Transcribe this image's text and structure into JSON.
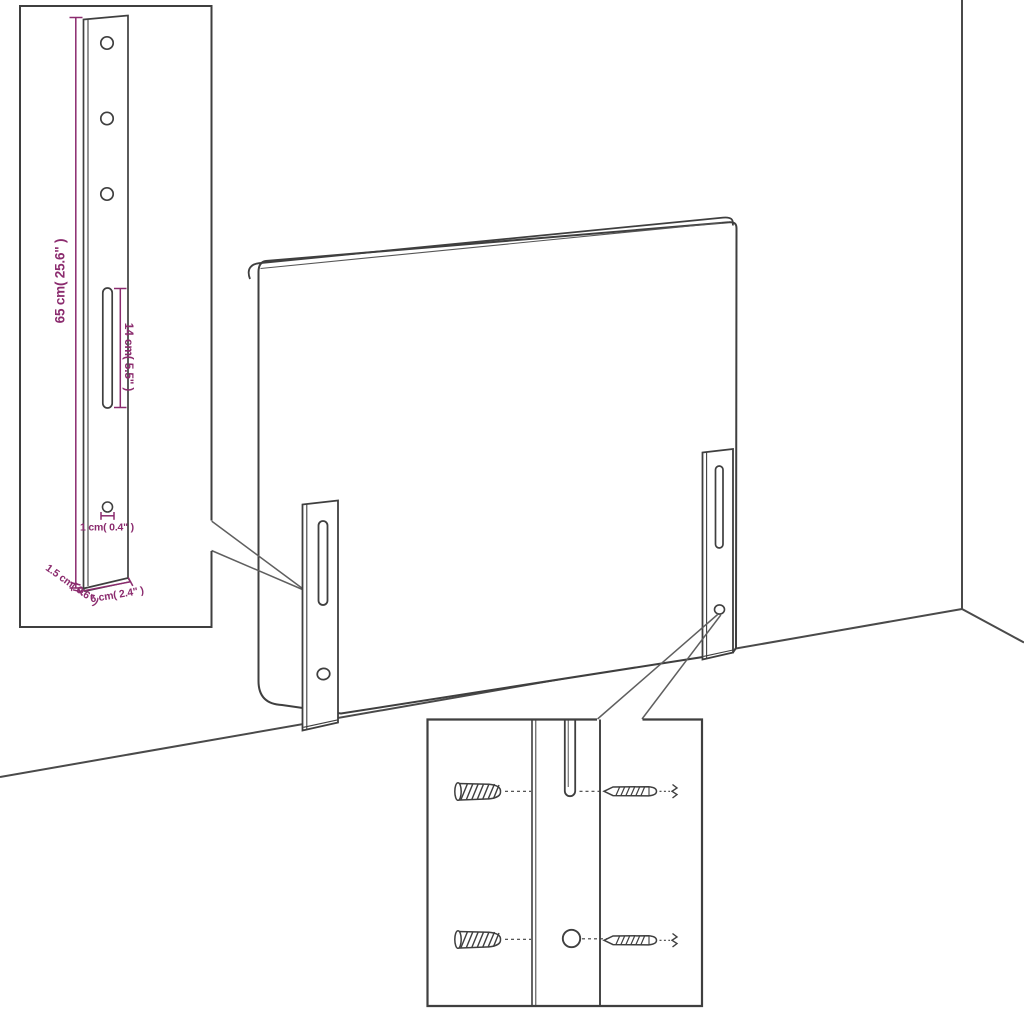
{
  "colors": {
    "outline": "#3f3f3f",
    "floor": "#4a4a4a",
    "callout": "#5f5f5f",
    "dimension": "#8b2b6e",
    "background": "#ffffff"
  },
  "dimensions": {
    "bracket_height": "65 cm( 25.6\" )",
    "slot_length": "14 cm( 5.5\" )",
    "hole_diameter": "1 cm( 0.4\" )",
    "bracket_thickness": "1.5 cm( 0.6\" )",
    "bracket_width": "6 cm( 2.4\" )"
  }
}
